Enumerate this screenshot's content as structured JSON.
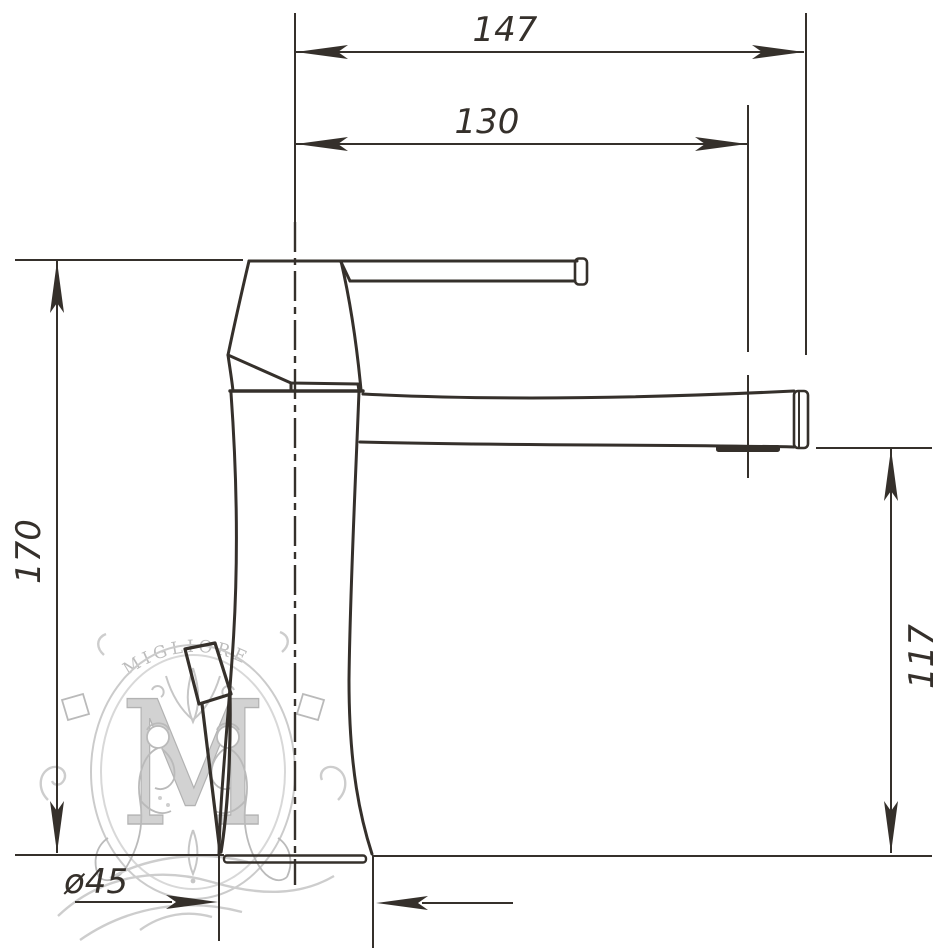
{
  "title": "Single-lever basin mixer technical drawing",
  "dims": {
    "overall_reach": "147",
    "spout_reach": "130",
    "overall_height": "170",
    "spout_height": "117",
    "base_diameter": "ø45"
  },
  "watermark": {
    "brand": "MIGLIORE",
    "monogram": "M"
  },
  "colors": {
    "line": "#35302b",
    "watermark": "#c6c6c6",
    "background": "#ffffff"
  }
}
